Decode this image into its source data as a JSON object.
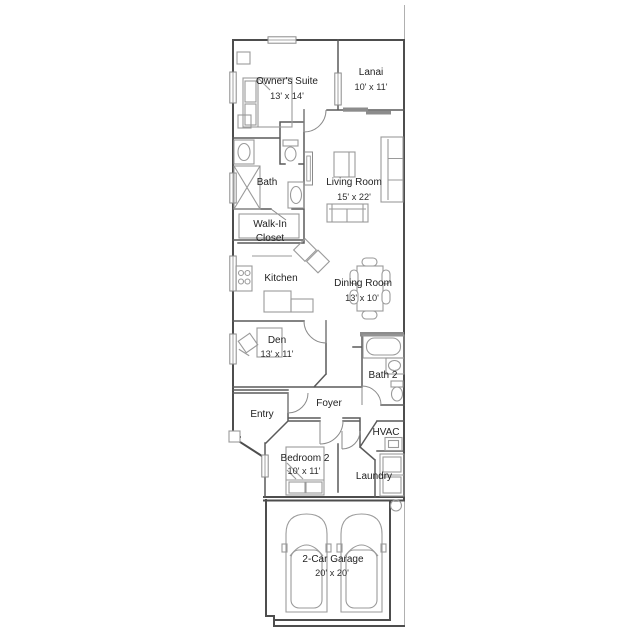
{
  "colors": {
    "background": "#ffffff",
    "wall": "#4d4d4d",
    "interior_wall": "#5a5a5a",
    "furniture": "#9a9a9a",
    "slider_fill": "#8c8c8c",
    "text": "#222222",
    "lot_line": "#b0b0b0"
  },
  "rooms": {
    "owners_suite": {
      "name": "Owner's Suite",
      "dims": "13' x 14'"
    },
    "lanai": {
      "name": "Lanai",
      "dims": "10' x 11'"
    },
    "living_room": {
      "name": "Living Room",
      "dims": "15' x 22'"
    },
    "bath": {
      "name": "Bath"
    },
    "walk_in_closet": {
      "line1": "Walk-In",
      "line2": "Closet"
    },
    "kitchen": {
      "name": "Kitchen"
    },
    "dining_room": {
      "name": "Dining Room",
      "dims": "13' x 10'"
    },
    "den": {
      "name": "Den",
      "dims": "13' x 11'"
    },
    "entry": {
      "name": "Entry"
    },
    "foyer": {
      "name": "Foyer"
    },
    "bath_2": {
      "name": "Bath 2"
    },
    "hvac": {
      "name": "HVAC"
    },
    "laundry": {
      "name": "Laundry"
    },
    "bedroom_2": {
      "name": "Bedroom 2",
      "dims": "10' x 11'"
    },
    "garage": {
      "name": "2-Car Garage",
      "dims": "20' x 20'"
    }
  }
}
